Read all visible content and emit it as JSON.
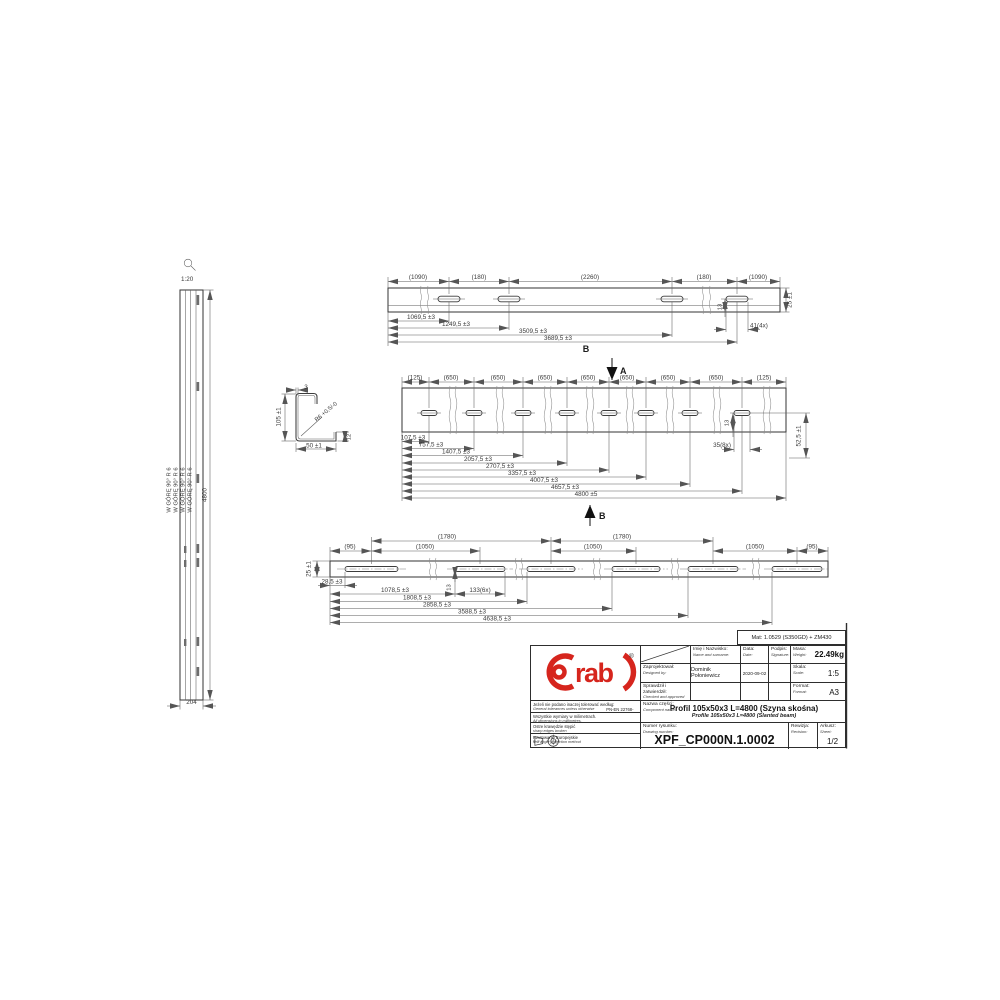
{
  "drawing": {
    "material_note": "Mat: 1.0529 (S350GD) + ZM430",
    "left_view": {
      "scale_label": "1:20",
      "bend_note": "W GÓRĘ 90° R 6",
      "length_dim": "4800",
      "width_dim": "204"
    },
    "section_detail": {
      "height_dim": "105 ±1",
      "thickness_dim": "3",
      "radius_dim": "R6 +0,5/-0",
      "width_dim": "50 ±1",
      "lip_dim": "12"
    },
    "top_view": {
      "view_label": "B",
      "dims_above": [
        "(1090)",
        "(180)",
        "(2260)",
        "(180)",
        "(1090)"
      ],
      "dims_below": [
        "1069,5 ±3",
        "1249,5 ±3",
        "3509,5 ±3",
        "3689,5 ±3"
      ],
      "slot_offset_dim": "13",
      "slot_size_dim": "41(4x)",
      "height_dim": "25 ±1"
    },
    "main_view": {
      "section_label_a": "A",
      "section_label_b": "B",
      "dims_above": [
        "(125)",
        "(650)",
        "(650)",
        "(650)",
        "(650)",
        "(650)",
        "(650)",
        "(650)",
        "(125)"
      ],
      "dims_below": [
        "107,5 ±3",
        "757,5 ±3",
        "1407,5 ±3",
        "2057,5 ±3",
        "2707,5 ±3",
        "3357,5 ±3",
        "4007,5 ±3",
        "4657,5 ±3",
        "4800 ±5"
      ],
      "slot_offset_dim": "13",
      "slot_size_dim": "35(8x)",
      "height_dim": "52,5 ±1"
    },
    "bottom_view": {
      "dims_above_upper": [
        "(1780)",
        "(1780)"
      ],
      "dims_above_lower": [
        "(95)",
        "(1050)",
        "(1050)",
        "(1050)",
        "(95)"
      ],
      "dims_below": [
        "28,5 ±3",
        "1078,5 ±3",
        "1808,5 ±3",
        "2858,5 ±3",
        "3588,5 ±3",
        "4638,5 ±3"
      ],
      "slot_offset_dim": "13",
      "slot_size_dim": "133(6x)",
      "height_dim": "25 ±1"
    }
  },
  "title_block": {
    "logo": {
      "text": "rab",
      "reg": "®"
    },
    "fields": {
      "name_pl": "Imię i Nazwisko:",
      "name_en": "Name and surname:",
      "date_pl": "Data:",
      "date_en": "Date:",
      "signature_pl": "Podpis:",
      "signature_en": "Signature:",
      "mass_pl": "Masa:",
      "mass_en": "Weight:",
      "mass_value": "22.49kg",
      "designed_pl": "Zaprojektował:",
      "designed_en": "Designed by:",
      "designer": "Dominik Połoniewicz",
      "design_date": "2020-09-02",
      "checked_pl": "Sprawdził i zatwierdził:",
      "checked_en": "Checked and approved by:",
      "scale_pl": "Skala:",
      "scale_en": "Scale:",
      "scale_value": "1:5",
      "format_pl": "Format:",
      "format_en": "Format:",
      "format_value": "A3",
      "part_pl": "Nazwa części:",
      "part_en": "Component name:",
      "part_name_pl": "Profil 105x50x3 L=4800 (Szyna skośna)",
      "part_name_en": "Profile 105x50x3 L=4800 (Slanted beam)",
      "number_pl": "Numer rysunku:",
      "number_en": "Drawing number:",
      "drawing_number": "XPF_CP000N.1.0002",
      "revision_pl": "Rewizja:",
      "revision_en": "Revision:",
      "sheet_pl": "Arkusz:",
      "sheet_en": "Sheet:",
      "sheet_value": "1/2"
    },
    "notes": {
      "tolerance_pl": "Jeżeli nie podano inaczej tolerować według:",
      "tolerance_en": "General tolerances unless otherwise specified",
      "tolerance_std": "PN-EN 22768-mK",
      "units_pl": "Wszystkie wymiary w milimetrach.",
      "units_en": "All dimensions in millimetres.",
      "edges_pl": "Ostre krawędzie stępić",
      "edges_en": "sharp edges broken",
      "projection_pl": "Rzutowanie Europejskie",
      "projection_en": "first angle projection method"
    }
  }
}
